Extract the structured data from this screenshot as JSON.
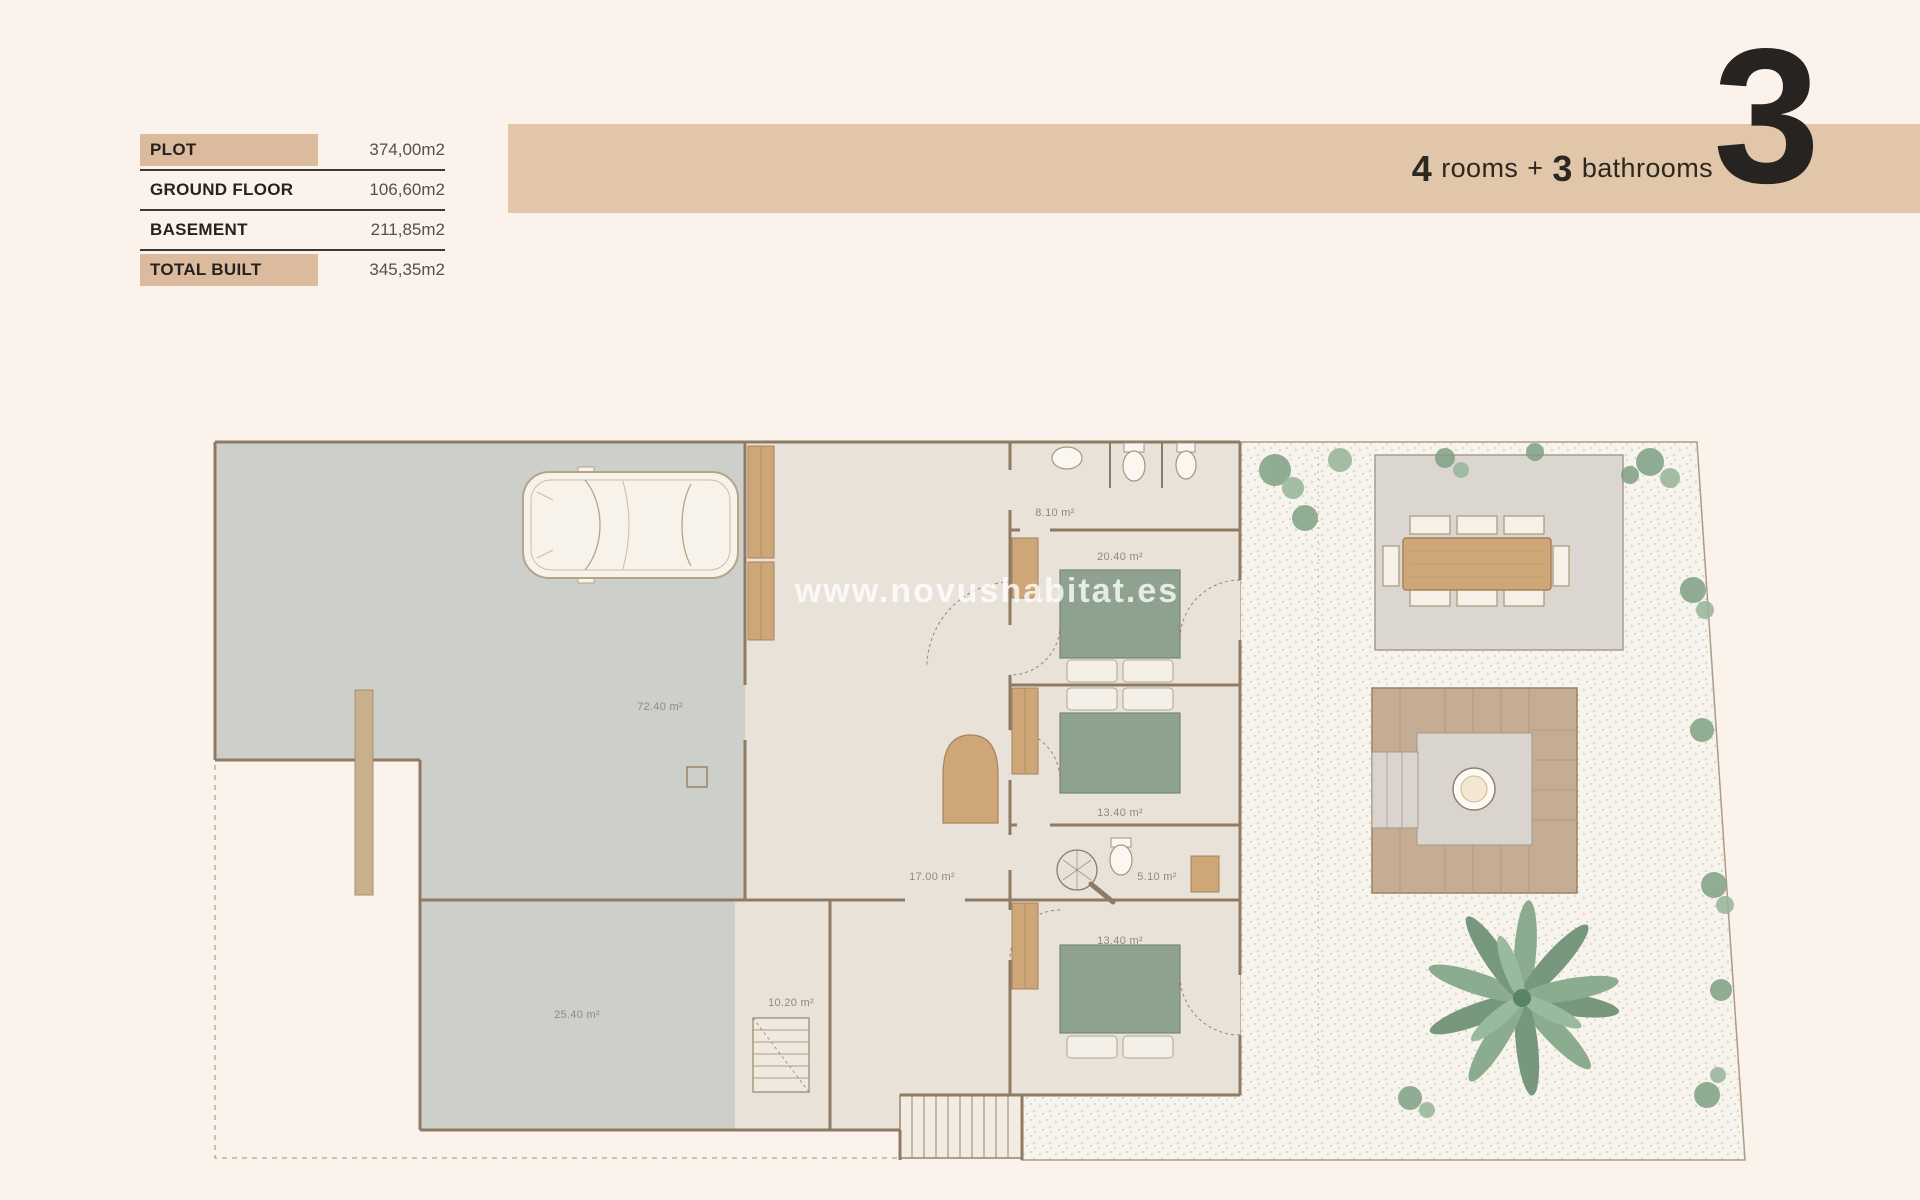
{
  "summary_table": {
    "rows": [
      {
        "label": "PLOT",
        "value": "374,00m2",
        "highlighted": true
      },
      {
        "label": "GROUND FLOOR",
        "value": "106,60m2",
        "highlighted": false
      },
      {
        "label": "BASEMENT",
        "value": "211,85m2",
        "highlighted": false
      },
      {
        "label": "TOTAL BUILT",
        "value": "345,35m2",
        "highlighted": true
      }
    ]
  },
  "banner": {
    "rooms_count": "4",
    "rooms_text": "rooms",
    "plus": "+",
    "bathrooms_count": "3",
    "bathrooms_text": "bathrooms",
    "big_number": "3"
  },
  "watermark": "www.novushabitat.es",
  "floor_plan": {
    "room_labels": [
      {
        "id": "garage",
        "text": "72.40 m²"
      },
      {
        "id": "bathroom-top",
        "text": "8.10 m²"
      },
      {
        "id": "bedroom-1",
        "text": "20.40 m²"
      },
      {
        "id": "bedroom-2",
        "text": "13.40 m²"
      },
      {
        "id": "hallway",
        "text": "17.00 m²"
      },
      {
        "id": "bathroom-mid",
        "text": "5.10 m²"
      },
      {
        "id": "bedroom-3",
        "text": "13.40 m²"
      },
      {
        "id": "stair-room",
        "text": "10.20 m²"
      },
      {
        "id": "basement-room",
        "text": "25.40 m²"
      }
    ]
  },
  "colors": {
    "background": "#fcf2ec",
    "banner": "#e2c6aa",
    "highlight": "#dcba9e",
    "wall": "#8f7b63",
    "floor_gray": "#cdcfca",
    "floor_beige": "#e9e2d9",
    "wood": "#cfa678",
    "bed_green": "#8fa28f",
    "plant_green": "#7fa184",
    "text_dark": "#262220"
  }
}
